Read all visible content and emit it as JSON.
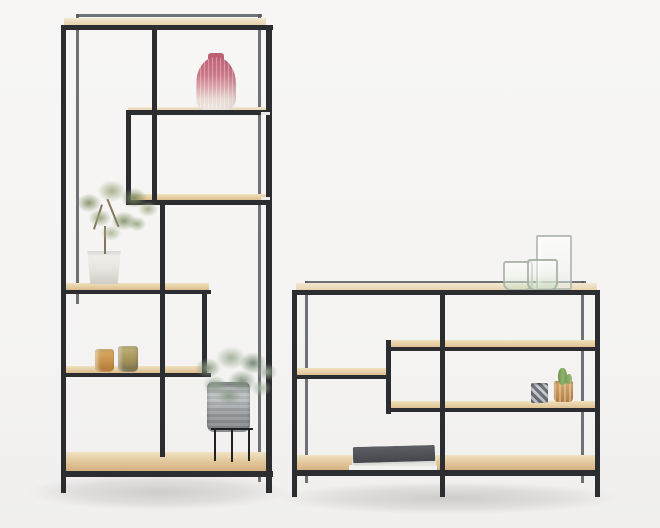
{
  "meta": {
    "domain": "natural-image",
    "description": "Studio product photograph of two matching shelving units - a tall asymmetric etagere on the left and a low wide console bookshelf on the right - both with slim black metal frames and light oak shelves, styled with plants, glassware, candle holders and books on a plain light backdrop",
    "text_visible": "none"
  },
  "palette": {
    "background": "#f6f5f3",
    "frame_black": "#2b2d31",
    "frame_rear_highlight": "#56595f",
    "oak_light": "#f0e2bf",
    "oak_dark": "#d8b586",
    "vase_pink": "#c97683",
    "olive_green": "#8a9b74",
    "eucalyptus_green": "#8fa18f",
    "amber_glass": "#c89054",
    "smoke_glass": "#9aa0a6",
    "book_cover_grey": "#55565a"
  },
  "units": [
    {
      "id": "tall-etagere",
      "position": "left",
      "style": "tall asymmetric open etagere, black metal frame, oak shelves",
      "decor": [
        {
          "item": "ribbed glass vase",
          "color": "pink fading to clear",
          "location": "top of middle box shelf"
        },
        {
          "item": "olive plant in white tapered pot",
          "location": "middle-left shelf"
        },
        {
          "item": "two amber glass tealight holders",
          "location": "lower-left shelf"
        },
        {
          "item": "eucalyptus plant in smoked glass pot on black metal stand",
          "location": "bottom shelf"
        }
      ]
    },
    {
      "id": "low-console",
      "position": "right",
      "style": "low wide staggered console bookshelf, black metal frame, oak shelves",
      "decor": [
        {
          "item": "clear glass carafe",
          "location": "top surface right"
        },
        {
          "item": "two drinking glasses",
          "color": "clear with green tint",
          "location": "top surface right"
        },
        {
          "item": "grey faceted glass tealight holder",
          "location": "middle-right shelf"
        },
        {
          "item": "amber glass tealight holder with mini cactus",
          "location": "middle-right shelf"
        },
        {
          "item": "stack of magazines with dark grey book on top",
          "location": "bottom-left shelf"
        }
      ]
    }
  ]
}
